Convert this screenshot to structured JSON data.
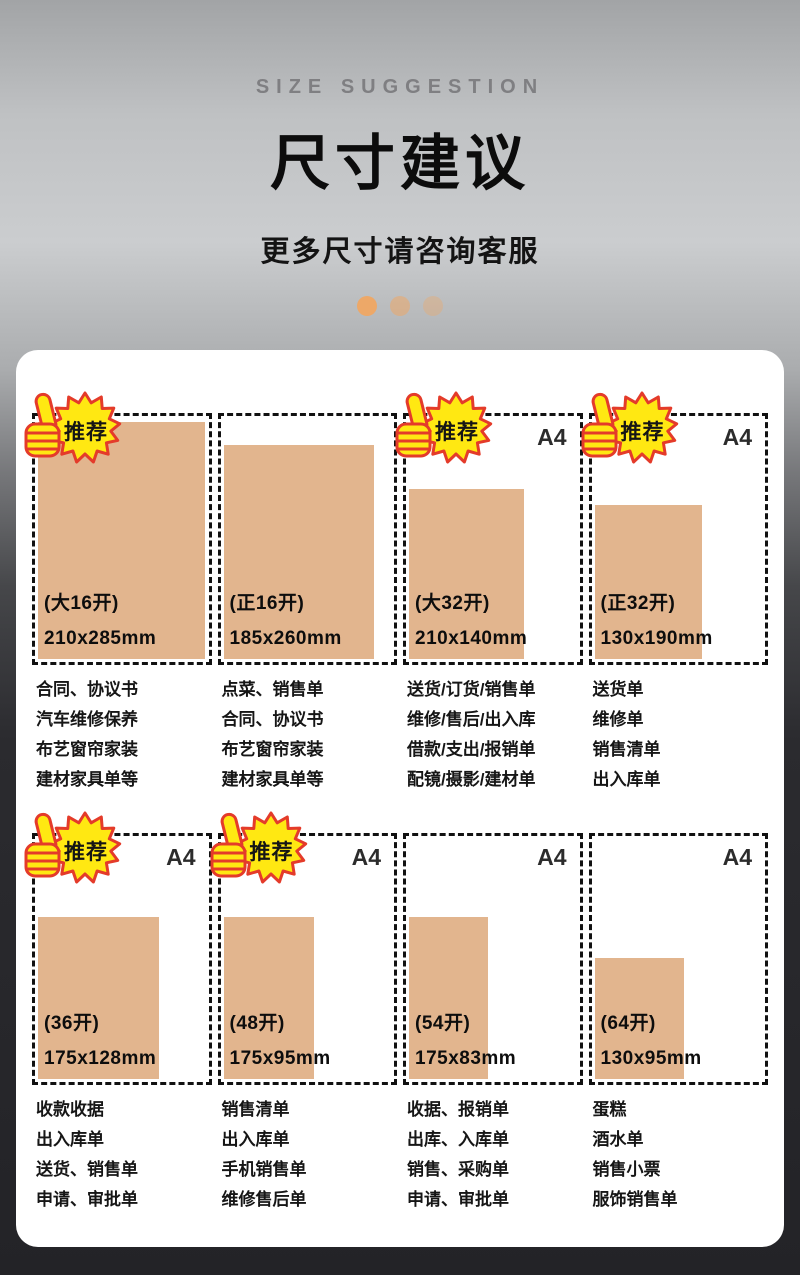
{
  "header": {
    "eyebrow": "SIZE SUGGESTION",
    "title": "尺寸建议",
    "subtitle": "更多尺寸请咨询客服",
    "carousel_dot_count": 3
  },
  "badge_label": "推荐",
  "a4_label": "A4",
  "colors": {
    "paper_fill": "#e2b58e",
    "badge_yellow": "#ffe812",
    "badge_red": "#e43b2a",
    "dot": "#eda868",
    "card_bg": "#ffffff"
  },
  "panels": [
    {
      "size_name": "(大16开)",
      "size_mm": "210x285mm",
      "recommended": true,
      "a4": false,
      "uses": [
        "合同、协议书",
        "汽车维修保养",
        "布艺窗帘家装",
        "建材家具单等"
      ]
    },
    {
      "size_name": "(正16开)",
      "size_mm": "185x260mm",
      "recommended": false,
      "a4": false,
      "uses": [
        "点菜、销售单",
        "合同、协议书",
        "布艺窗帘家装",
        "建材家具单等"
      ]
    },
    {
      "size_name": "(大32开)",
      "size_mm": "210x140mm",
      "recommended": true,
      "a4": true,
      "uses": [
        "送货/订货/销售单",
        "维修/售后/出入库",
        "借款/支出/报销单",
        "配镜/摄影/建材单"
      ]
    },
    {
      "size_name": "(正32开)",
      "size_mm": "130x190mm",
      "recommended": true,
      "a4": true,
      "uses": [
        "送货单",
        "维修单",
        "销售清单",
        "出入库单"
      ]
    },
    {
      "size_name": "(36开)",
      "size_mm": "175x128mm",
      "recommended": true,
      "a4": true,
      "uses": [
        "收款收据",
        "出入库单",
        "送货、销售单",
        "申请、审批单"
      ]
    },
    {
      "size_name": "(48开)",
      "size_mm": "175x95mm",
      "recommended": true,
      "a4": true,
      "uses": [
        "销售清单",
        "出入库单",
        "手机销售单",
        "维修售后单"
      ]
    },
    {
      "size_name": "(54开)",
      "size_mm": "175x83mm",
      "recommended": false,
      "a4": true,
      "uses": [
        "收据、报销单",
        "出库、入库单",
        "销售、采购单",
        "申请、审批单"
      ]
    },
    {
      "size_name": "(64开)",
      "size_mm": "130x95mm",
      "recommended": false,
      "a4": true,
      "uses": [
        "蛋糕",
        "酒水单",
        "销售小票",
        "服饰销售单"
      ]
    }
  ]
}
